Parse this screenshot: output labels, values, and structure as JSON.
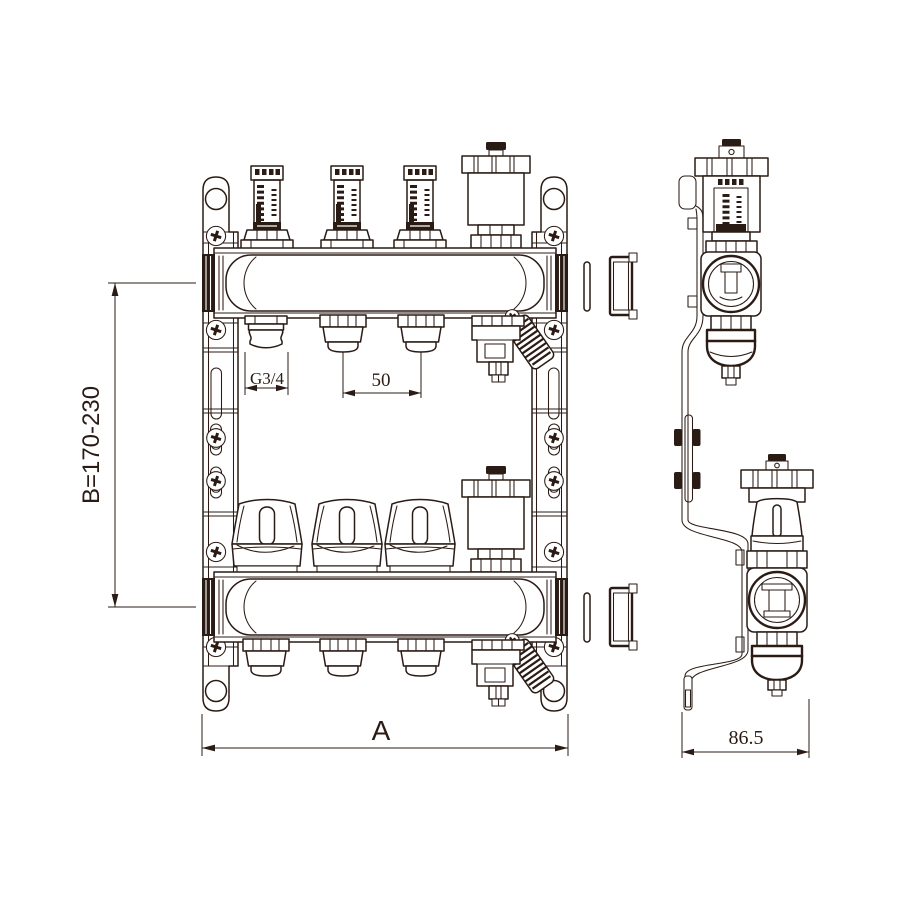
{
  "drawing": {
    "background": "#ffffff",
    "line_color": "#2b1b15",
    "circuit_count": 3,
    "dimensions": {
      "height_range": "B=170-230",
      "port_thread": "G3/4",
      "port_spacing": "50",
      "overall_width": "A",
      "depth": "86.5"
    }
  }
}
